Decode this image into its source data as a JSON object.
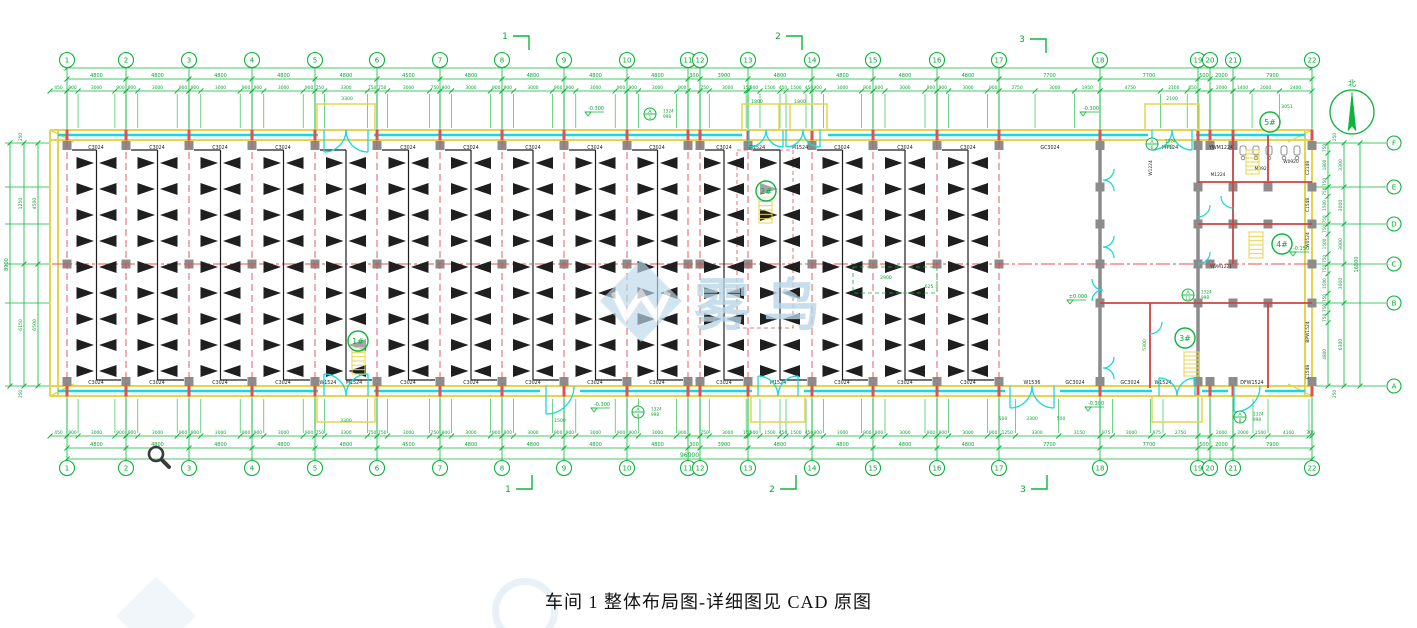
{
  "title": {
    "text": "车间 1 整体布局图-详细图见 CAD 原图"
  },
  "watermark": {
    "text": "雾鸟"
  },
  "compass": {
    "label": "北",
    "x": 1352,
    "y": 112,
    "r": 22
  },
  "colors": {
    "green": "#0db53c",
    "dim": "#0aa636",
    "yellow": "#e6d44e",
    "cyan": "#16d8e0",
    "red": "#e05050",
    "wall_red": "#cc4444",
    "gray": "#8c8c8c",
    "black": "#1f1f1f",
    "wm_blue": "#b9d6e8"
  },
  "building": {
    "left": 50,
    "right": 1312,
    "top": 130,
    "in_top": 140,
    "in_bottom": 386,
    "bottom": 396,
    "mid_y": 264
  },
  "grid": {
    "cols": [
      {
        "label": "1",
        "x": 67
      },
      {
        "label": "2",
        "x": 126
      },
      {
        "label": "3",
        "x": 189
      },
      {
        "label": "4",
        "x": 252
      },
      {
        "label": "5",
        "x": 315
      },
      {
        "label": "6",
        "x": 377
      },
      {
        "label": "7",
        "x": 440
      },
      {
        "label": "8",
        "x": 502
      },
      {
        "label": "9",
        "x": 564
      },
      {
        "label": "10",
        "x": 627
      },
      {
        "label": "11",
        "x": 688
      },
      {
        "label": "12",
        "x": 700
      },
      {
        "label": "13",
        "x": 748
      },
      {
        "label": "14",
        "x": 812
      },
      {
        "label": "15",
        "x": 873
      },
      {
        "label": "16",
        "x": 937
      },
      {
        "label": "17",
        "x": 999
      },
      {
        "label": "18",
        "x": 1100
      },
      {
        "label": "19",
        "x": 1198
      },
      {
        "label": "20",
        "x": 1210
      },
      {
        "label": "21",
        "x": 1233
      },
      {
        "label": "22",
        "x": 1312
      }
    ],
    "rows": [
      {
        "label": "F",
        "y": 143
      },
      {
        "label": "E",
        "y": 187
      },
      {
        "label": "D",
        "y": 224
      },
      {
        "label": "C",
        "y": 264
      },
      {
        "label": "B",
        "y": 303
      },
      {
        "label": "A",
        "y": 386
      }
    ]
  },
  "dims": {
    "top_total": "96000",
    "bottom_total": "96000",
    "lead": "450",
    "bays": [
      "4800",
      "4800",
      "4800",
      "4800",
      "4800",
      "4500",
      "4800",
      "4800",
      "4800",
      "4800",
      "300",
      "3900",
      "4800",
      "4800",
      "4800",
      "4800",
      "7700",
      "7700",
      "500",
      "2000",
      "7900"
    ],
    "sub_default": [
      "900",
      "3000",
      "900"
    ],
    "top_overrides": {
      "4": [
        "750",
        "3300",
        "750"
      ],
      "5": [
        "750",
        "3000",
        "750"
      ],
      "10": [],
      "11": [
        "750",
        "3000",
        "150"
      ],
      "12": [
        "900",
        "1500",
        "450",
        "1500",
        "450"
      ],
      "16": [
        "2750",
        "3000",
        "1950"
      ],
      "17": [
        "4750",
        "2100",
        "850"
      ],
      "18": [],
      "19": [
        "2000"
      ],
      "20": [
        "1400",
        "2000",
        "2400"
      ]
    },
    "bottom_overrides": {
      "4": [
        "750",
        "3300",
        "750"
      ],
      "5": [
        "750",
        "3000",
        "750"
      ],
      "10": [],
      "11": [
        "750",
        "3000",
        "150"
      ],
      "12": [
        "900",
        "1500",
        "450",
        "1500",
        "450"
      ],
      "16": [
        "1250",
        "3300",
        "3150"
      ],
      "17": [
        "975",
        "3000",
        "975",
        "2750"
      ],
      "18": [],
      "19": [
        "2000"
      ],
      "20": [
        "2000",
        "1500",
        "4100",
        "300"
      ]
    },
    "left": {
      "total": "8900",
      "upper": [
        "1250",
        "4500"
      ],
      "lower": [
        "6150",
        "6500"
      ],
      "end": "250"
    },
    "right": {
      "total": "16800",
      "spans": [
        "3300",
        "3000",
        "3000",
        "3000",
        "6300"
      ],
      "subs": [
        [
          "750",
          "1800",
          "750"
        ],
        [
          "750",
          "1500",
          "750"
        ],
        [
          "750",
          "1500",
          "750"
        ],
        [
          "750",
          "1500",
          "750"
        ],
        [
          "750",
          "750",
          "4800"
        ]
      ],
      "end": "250"
    }
  },
  "trusses": {
    "bay_indices": [
      0,
      1,
      2,
      3,
      4,
      5,
      6,
      7,
      8,
      9,
      11,
      12,
      13,
      14,
      15
    ],
    "rows_y": [
      163,
      189,
      215,
      241,
      267,
      293,
      319,
      345,
      371
    ]
  },
  "wall_labels": {
    "top": [
      {
        "x": 96,
        "t": "C3024"
      },
      {
        "x": 157,
        "t": "C3024"
      },
      {
        "x": 220,
        "t": "C3024"
      },
      {
        "x": 283,
        "t": "C3024"
      },
      {
        "x": 408,
        "t": "C3024"
      },
      {
        "x": 471,
        "t": "C3024"
      },
      {
        "x": 533,
        "t": "C3024"
      },
      {
        "x": 595,
        "t": "C3024"
      },
      {
        "x": 657,
        "t": "C3024"
      },
      {
        "x": 724,
        "t": "C3024"
      },
      {
        "x": 842,
        "t": "C3024"
      },
      {
        "x": 905,
        "t": "C3024"
      },
      {
        "x": 968,
        "t": "C3024"
      },
      {
        "x": 1050,
        "t": "GC3024"
      },
      {
        "x": 757,
        "t": "M1524"
      },
      {
        "x": 800,
        "t": "M1524"
      },
      {
        "x": 1170,
        "t": "M7124"
      },
      {
        "x": 1221,
        "t": "YWM1224"
      }
    ],
    "bottom": [
      {
        "x": 96,
        "t": "C3024"
      },
      {
        "x": 157,
        "t": "C3024"
      },
      {
        "x": 220,
        "t": "C3024"
      },
      {
        "x": 283,
        "t": "C3024"
      },
      {
        "x": 408,
        "t": "C3024"
      },
      {
        "x": 471,
        "t": "C3024"
      },
      {
        "x": 533,
        "t": "C3024"
      },
      {
        "x": 595,
        "t": "C3024"
      },
      {
        "x": 657,
        "t": "C3024"
      },
      {
        "x": 724,
        "t": "C3024"
      },
      {
        "x": 842,
        "t": "C3024"
      },
      {
        "x": 905,
        "t": "C3024"
      },
      {
        "x": 968,
        "t": "C3024"
      },
      {
        "x": 1075,
        "t": "GC3024"
      },
      {
        "x": 1130,
        "t": "GC3024"
      },
      {
        "x": 328,
        "t": "W1524"
      },
      {
        "x": 354,
        "t": "M1524"
      },
      {
        "x": 778,
        "t": "M1524"
      },
      {
        "x": 1032,
        "t": "W1536"
      },
      {
        "x": 1163,
        "t": "W1524"
      },
      {
        "x": 1252,
        "t": "DFW1524"
      }
    ],
    "right_wall": [
      {
        "y": 168,
        "t": "C2148"
      },
      {
        "y": 205,
        "t": "C1548"
      },
      {
        "y": 240,
        "t": "W0524"
      },
      {
        "y": 332,
        "t": "BPW1524"
      },
      {
        "y": 372,
        "t": "C1548"
      }
    ],
    "interior": [
      {
        "x": 1152,
        "y": 168,
        "t": "W1224",
        "r": -90
      },
      {
        "x": 1218,
        "y": 176,
        "t": "M1224"
      },
      {
        "x": 1221,
        "y": 268,
        "t": "YWM1221"
      },
      {
        "x": 1262,
        "y": 170,
        "t": "M0921"
      },
      {
        "x": 1291,
        "y": 163,
        "t": "W0920"
      }
    ]
  },
  "doors": {
    "top": [
      {
        "cx": 346,
        "w": 44
      },
      {
        "cx": 766,
        "w": 34
      },
      {
        "cx": 803,
        "w": 34
      },
      {
        "cx": 1172,
        "w": 40
      }
    ],
    "bottom": [
      {
        "cx": 346,
        "w": 44,
        "dbl": true,
        "out": true
      },
      {
        "cx": 560,
        "w": 28,
        "dbl": false,
        "out": false
      },
      {
        "cx": 778,
        "w": 40,
        "dbl": true,
        "out": true
      },
      {
        "cx": 1032,
        "w": 44,
        "dbl": true,
        "out": false
      },
      {
        "cx": 1177,
        "w": 36,
        "dbl": true,
        "out": true
      },
      {
        "cx": 1247,
        "w": 26,
        "dbl": false,
        "out": false
      }
    ]
  },
  "right_section": {
    "walls_red": [
      [
        1233,
        135,
        1233,
        264
      ],
      [
        1268,
        135,
        1268,
        182
      ],
      [
        1198,
        182,
        1312,
        182
      ],
      [
        1198,
        224,
        1312,
        224
      ],
      [
        1100,
        303,
        1312,
        303
      ],
      [
        1150,
        303,
        1150,
        388
      ],
      [
        1268,
        303,
        1268,
        388
      ]
    ],
    "walls_gray": [
      [
        1100,
        140,
        1100,
        386
      ],
      [
        1198,
        140,
        1198,
        386
      ]
    ],
    "butterflies": [
      {
        "x": 1103,
        "y": 180,
        "dir": 1
      },
      {
        "x": 1103,
        "y": 247,
        "dir": 1
      },
      {
        "x": 1103,
        "y": 290,
        "dir": -1
      },
      {
        "x": 1103,
        "y": 368,
        "dir": 1
      }
    ],
    "q_doors": [
      {
        "x": 1198,
        "y": 205,
        "dir": 1
      },
      {
        "x": 1198,
        "y": 252,
        "dir": 1
      },
      {
        "x": 1233,
        "y": 196,
        "dir": -1
      },
      {
        "x": 1150,
        "y": 322,
        "dir": 1
      }
    ],
    "fixtures_x": [
      1243,
      1256,
      1269,
      1284,
      1297
    ],
    "fixtures_y": 146
  },
  "stairs": {
    "circles": [
      {
        "t": "1#",
        "x": 358,
        "y": 341
      },
      {
        "t": "2#",
        "x": 766,
        "y": 191
      },
      {
        "t": "3#",
        "x": 1185,
        "y": 338
      },
      {
        "t": "4#",
        "x": 1282,
        "y": 244
      },
      {
        "t": "5#",
        "x": 1270,
        "y": 122
      }
    ],
    "blocks": [
      {
        "x": 352,
        "y": 348,
        "w": 13,
        "h": 26
      },
      {
        "x": 759,
        "y": 197,
        "w": 13,
        "h": 26
      },
      {
        "x": 1184,
        "y": 352,
        "w": 15,
        "h": 24
      },
      {
        "x": 1249,
        "y": 232,
        "w": 14,
        "h": 26
      },
      {
        "x": 1246,
        "y": 150,
        "w": 13,
        "h": 24
      }
    ]
  },
  "levels": [
    {
      "t": "-0.300",
      "x": 588,
      "y": 112
    },
    {
      "t": "-0.300",
      "x": 1083,
      "y": 112
    },
    {
      "t": "-0.300",
      "x": 594,
      "y": 408
    },
    {
      "t": "-0.300",
      "x": 1088,
      "y": 407
    },
    {
      "t": "±0.000",
      "x": 1070,
      "y": 300
    },
    {
      "t": "-0.150",
      "x": 1293,
      "y": 252
    }
  ],
  "callouts": [
    {
      "x": 650,
      "y": 114,
      "a": "A",
      "n": "1",
      "s1": "1324",
      "s2": "998"
    },
    {
      "x": 1152,
      "y": 144,
      "a": "A",
      "n": "6",
      "s1": "1324",
      "s2": "998"
    },
    {
      "x": 638,
      "y": 412,
      "a": "A",
      "n": "4",
      "s1": "1324",
      "s2": "998"
    },
    {
      "x": 1188,
      "y": 295,
      "a": "A",
      "n": "13",
      "s1": "1324",
      "s2": "998"
    },
    {
      "x": 1240,
      "y": 417,
      "a": "A",
      "n": "8",
      "s1": "1324",
      "s2": "998"
    }
  ],
  "extra_texts": [
    {
      "t": "3300",
      "x": 347,
      "y": 100
    },
    {
      "t": "1800",
      "x": 757,
      "y": 103
    },
    {
      "t": "1800",
      "x": 800,
      "y": 103
    },
    {
      "t": "2900",
      "x": 886,
      "y": 279
    },
    {
      "t": "625",
      "x": 929,
      "y": 288
    },
    {
      "t": "3051",
      "x": 1287,
      "y": 108
    },
    {
      "t": "5300",
      "x": 1146,
      "y": 345,
      "r": -90
    },
    {
      "t": "2100",
      "x": 1172,
      "y": 100
    },
    {
      "t": "500",
      "x": 1003,
      "y": 420
    },
    {
      "t": "3300",
      "x": 1032,
      "y": 420
    },
    {
      "t": "500",
      "x": 1061,
      "y": 420
    },
    {
      "t": "3300",
      "x": 346,
      "y": 422
    },
    {
      "t": "1500",
      "x": 560,
      "y": 422
    }
  ],
  "detail_rect": {
    "x": 853,
    "y": 267,
    "w": 84,
    "h": 26
  },
  "sections": {
    "top": [
      {
        "label": "1",
        "x": 505,
        "y": 36
      },
      {
        "label": "2",
        "x": 778,
        "y": 36
      },
      {
        "label": "3",
        "x": 1022,
        "y": 39
      }
    ],
    "bottom": [
      {
        "label": "1",
        "x": 508,
        "y": 489
      },
      {
        "label": "2",
        "x": 772,
        "y": 489
      },
      {
        "label": "3",
        "x": 1023,
        "y": 489
      }
    ]
  }
}
